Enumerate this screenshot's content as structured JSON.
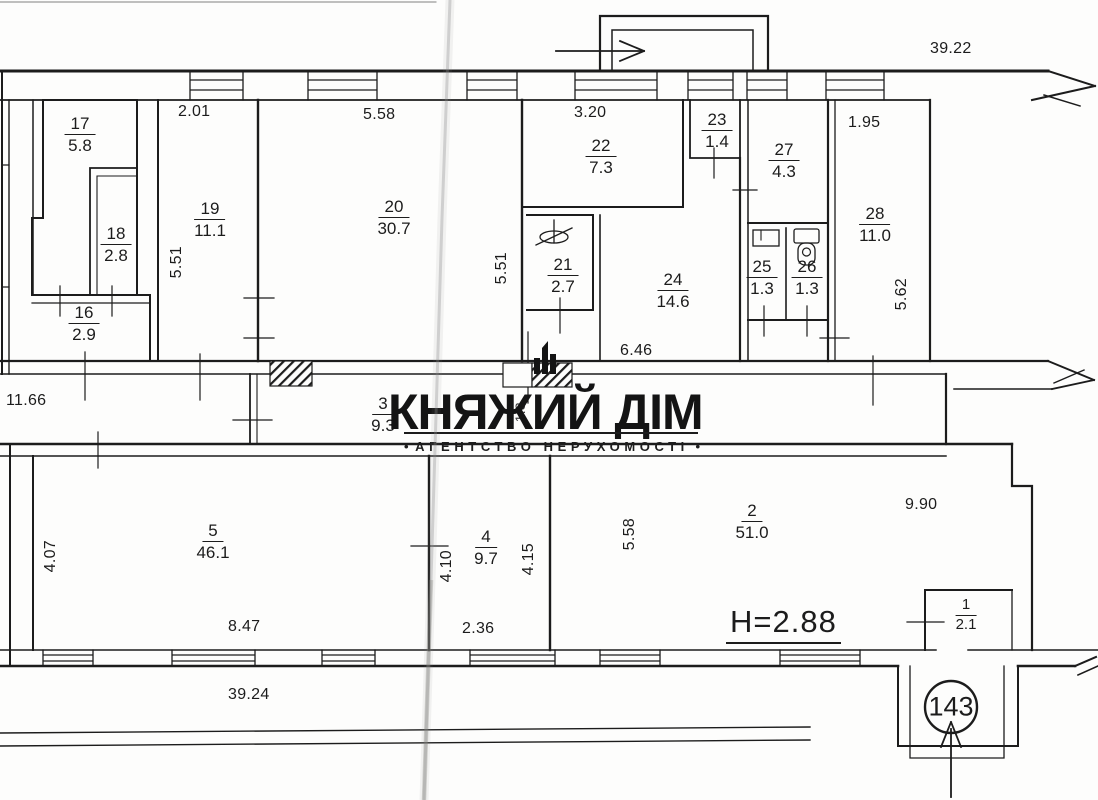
{
  "watermark": {
    "title": "КНЯЖИЙ ДІМ",
    "bullet": "•",
    "subtitle": "АГЕНТСТВО НЕРУХОМОСТІ"
  },
  "plan": {
    "rooms": [
      {
        "num": "17",
        "area": "5.8"
      },
      {
        "num": "18",
        "area": "2.8"
      },
      {
        "num": "16",
        "area": "2.9"
      },
      {
        "num": "19",
        "area": "11.1"
      },
      {
        "num": "20",
        "area": "30.7"
      },
      {
        "num": "22",
        "area": "7.3"
      },
      {
        "num": "23",
        "area": "1.4"
      },
      {
        "num": "27",
        "area": "4.3"
      },
      {
        "num": "28",
        "area": "11.0"
      },
      {
        "num": "21",
        "area": "2.7"
      },
      {
        "num": "24",
        "area": "14.6"
      },
      {
        "num": "25",
        "area": "1.3"
      },
      {
        "num": "26",
        "area": "1.3"
      },
      {
        "num": "3",
        "area": "9.3"
      },
      {
        "num": "5",
        "area": "46.1"
      },
      {
        "num": "4",
        "area": "9.7"
      },
      {
        "num": "2",
        "area": "51.0"
      },
      {
        "num": "1",
        "area": "2.1"
      }
    ],
    "dims": {
      "len_top": "39.22",
      "len_bottom": "39.24",
      "w19": "2.01",
      "w20": "5.58",
      "w22": "3.20",
      "w28": "1.95",
      "h19": "5.51",
      "h20": "5.51",
      "h28": "5.62",
      "w24": "6.46",
      "corridor_len": "11.66",
      "corridor_w": "1.3",
      "h5": "4.07",
      "w5": "8.47",
      "h4l": "4.10",
      "h4r": "4.15",
      "w4": "2.36",
      "h2": "5.58",
      "w2r": "9.90"
    },
    "ceiling_height": "H=2.88",
    "entrance_number": "143"
  },
  "icons": {
    "sink": "sink-icon",
    "cistern": "cistern-icon",
    "toilet": "toilet-icon",
    "entry_arrow": "entry-arrow-icon",
    "entrance_arrow": "entrance-arrow-icon",
    "logo_building": "logo-building-icon",
    "break_arrow": "wall-break-arrow-icon"
  },
  "colors": {
    "ink": "#1c1c1c",
    "paper": "#fdfdfc",
    "crease": "#8a8a8a"
  }
}
